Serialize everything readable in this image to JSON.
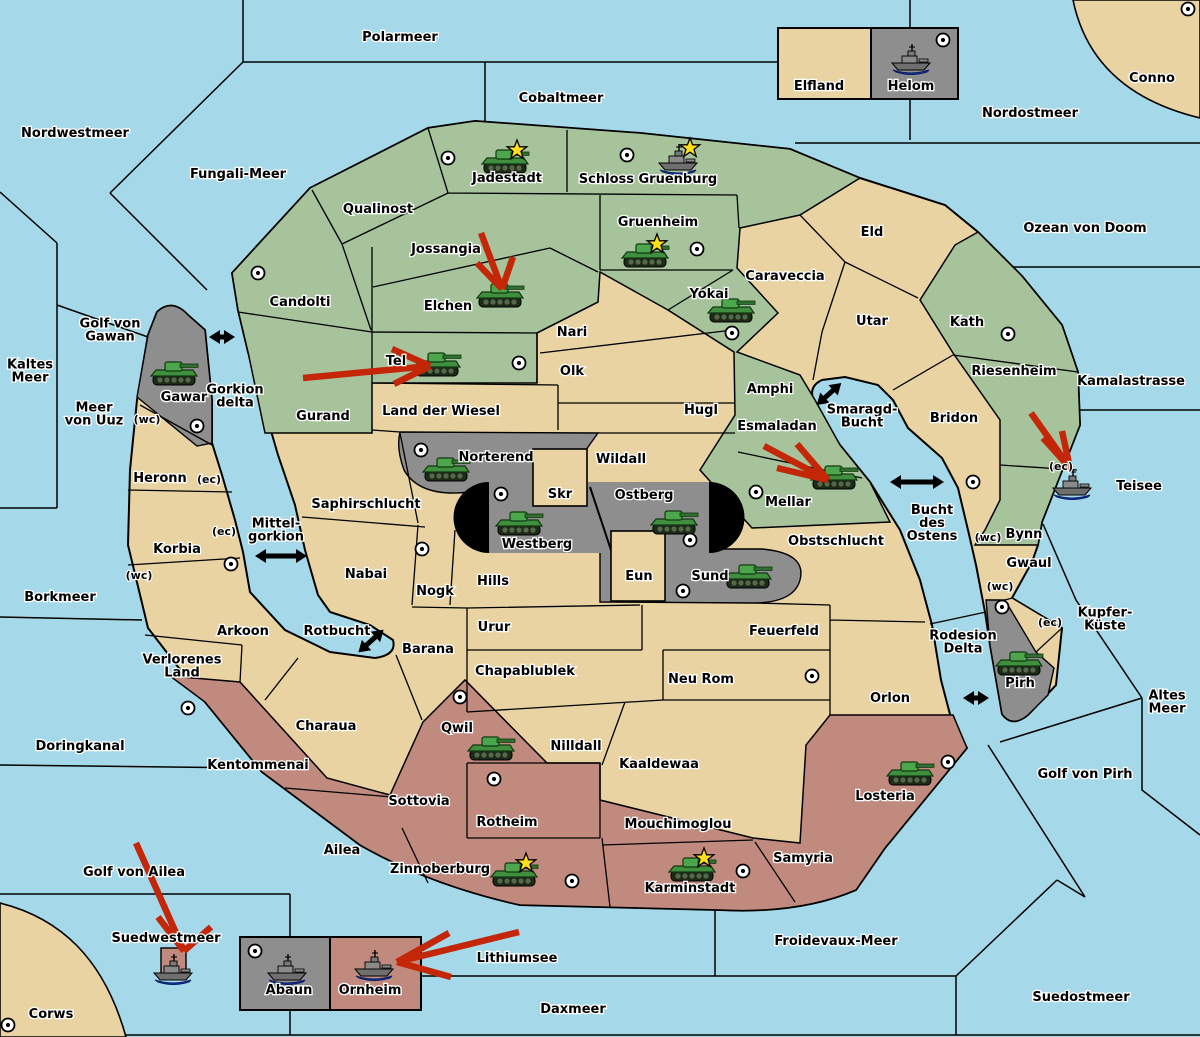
{
  "colors": {
    "sea": "#A5D8E8",
    "land": "#E9D3A3",
    "green": "#A6C39B",
    "maroon": "#C18A7E",
    "gray": "#8E8E8E",
    "ring": "#000000",
    "arrow_red": "#C42708",
    "tank_green": "#3F8F3F",
    "ship_gray": "#7A7A7A",
    "star_yellow": "#FFE01A"
  },
  "sea_labels": [
    {
      "text": "Polarmeer",
      "x": 400,
      "y": 37
    },
    {
      "text": "Cobaltmeer",
      "x": 561,
      "y": 98
    },
    {
      "text": "Nordostmeer",
      "x": 1030,
      "y": 113
    },
    {
      "text": "Nordwestmeer",
      "x": 75,
      "y": 133
    },
    {
      "text": "Fungali-Meer",
      "x": 238,
      "y": 174
    },
    {
      "text": "Ozean von Doom",
      "x": 1085,
      "y": 228
    },
    {
      "lines": [
        "Kaltes",
        "Meer"
      ],
      "x": 30,
      "y": 371
    },
    {
      "lines": [
        "Golf von",
        "Gawan"
      ],
      "x": 110,
      "y": 330
    },
    {
      "lines": [
        "Meer",
        "von Uuz"
      ],
      "x": 94,
      "y": 414
    },
    {
      "lines": [
        "Gorkion",
        "delta"
      ],
      "x": 235,
      "y": 396
    },
    {
      "text": "Borkmeer",
      "x": 60,
      "y": 597
    },
    {
      "lines": [
        "Mittel-",
        "gorkion"
      ],
      "x": 276,
      "y": 530
    },
    {
      "text": "Rotbucht",
      "x": 337,
      "y": 631
    },
    {
      "lines": [
        "Smaragd-",
        "Bucht"
      ],
      "x": 862,
      "y": 416
    },
    {
      "lines": [
        "Bucht",
        "des",
        "Ostens"
      ],
      "x": 932,
      "y": 523
    },
    {
      "text": "Kamalastrasse",
      "x": 1131,
      "y": 381
    },
    {
      "text": "Teisee",
      "x": 1139,
      "y": 486
    },
    {
      "lines": [
        "Kupfer-",
        "Küste"
      ],
      "x": 1105,
      "y": 619
    },
    {
      "lines": [
        "Altes",
        "Meer"
      ],
      "x": 1167,
      "y": 702
    },
    {
      "text": "Golf von Pirh",
      "x": 1085,
      "y": 774
    },
    {
      "lines": [
        "Rodesion",
        "Delta"
      ],
      "x": 963,
      "y": 642
    },
    {
      "text": "Doringkanal",
      "x": 80,
      "y": 746
    },
    {
      "text": "Golf von Ailea",
      "x": 134,
      "y": 872
    },
    {
      "text": "Suedwestmeer",
      "x": 166,
      "y": 938
    },
    {
      "text": "Lithiumsee",
      "x": 517,
      "y": 958
    },
    {
      "text": "Daxmeer",
      "x": 573,
      "y": 1009
    },
    {
      "text": "Froidevaux-Meer",
      "x": 836,
      "y": 941
    },
    {
      "text": "Suedostmeer",
      "x": 1081,
      "y": 997
    }
  ],
  "province_labels": [
    {
      "text": "Conno",
      "x": 1152,
      "y": 78
    },
    {
      "text": "Elfland",
      "x": 819,
      "y": 86
    },
    {
      "text": "Helom",
      "x": 911,
      "y": 86
    },
    {
      "text": "Qualinost",
      "x": 378,
      "y": 209
    },
    {
      "text": "Candolti",
      "x": 300,
      "y": 302
    },
    {
      "text": "Jossangia",
      "x": 446,
      "y": 249
    },
    {
      "text": "Jadestadt",
      "x": 507,
      "y": 178
    },
    {
      "text": "Schloss Gruenburg",
      "x": 648,
      "y": 179
    },
    {
      "text": "Gruenheim",
      "x": 658,
      "y": 222
    },
    {
      "text": "Elchen",
      "x": 448,
      "y": 306
    },
    {
      "text": "Tel",
      "x": 396,
      "y": 361
    },
    {
      "text": "Yokai",
      "x": 709,
      "y": 294
    },
    {
      "text": "Caraveccia",
      "x": 785,
      "y": 276
    },
    {
      "text": "Eld",
      "x": 872,
      "y": 232
    },
    {
      "text": "Utar",
      "x": 872,
      "y": 321
    },
    {
      "text": "Kath",
      "x": 967,
      "y": 322
    },
    {
      "text": "Riesenheim",
      "x": 1014,
      "y": 371
    },
    {
      "text": "Bridon",
      "x": 954,
      "y": 418
    },
    {
      "text": "Gurand",
      "x": 323,
      "y": 416
    },
    {
      "text": "Land der Wiesel",
      "x": 441,
      "y": 411
    },
    {
      "text": "Nari",
      "x": 572,
      "y": 332
    },
    {
      "text": "Olk",
      "x": 572,
      "y": 371
    },
    {
      "text": "Hugl",
      "x": 701,
      "y": 410
    },
    {
      "text": "Amphi",
      "x": 770,
      "y": 389
    },
    {
      "text": "Esmaladan",
      "x": 777,
      "y": 426
    },
    {
      "text": "Mellar",
      "x": 788,
      "y": 502
    },
    {
      "text": "Wildall",
      "x": 621,
      "y": 459
    },
    {
      "text": "Norterend",
      "x": 496,
      "y": 457
    },
    {
      "text": "Skr",
      "x": 560,
      "y": 494
    },
    {
      "text": "Ostberg",
      "x": 644,
      "y": 495
    },
    {
      "text": "Westberg",
      "x": 537,
      "y": 544
    },
    {
      "text": "Eun",
      "x": 639,
      "y": 576
    },
    {
      "text": "Sund",
      "x": 710,
      "y": 576
    },
    {
      "text": "Gawar",
      "x": 184,
      "y": 397
    },
    {
      "text": "Heronn",
      "x": 160,
      "y": 478
    },
    {
      "text": "Korbia",
      "x": 177,
      "y": 549
    },
    {
      "text": "Saphirschlucht",
      "x": 366,
      "y": 504
    },
    {
      "text": "Nabai",
      "x": 366,
      "y": 574
    },
    {
      "text": "Nogk",
      "x": 435,
      "y": 591
    },
    {
      "text": "Hills",
      "x": 493,
      "y": 581
    },
    {
      "text": "Urur",
      "x": 494,
      "y": 627
    },
    {
      "text": "Barana",
      "x": 428,
      "y": 649
    },
    {
      "text": "Chapablublek",
      "x": 525,
      "y": 671
    },
    {
      "text": "Nilldall",
      "x": 576,
      "y": 746
    },
    {
      "text": "Kaaldewaa",
      "x": 659,
      "y": 764
    },
    {
      "text": "Feuerfeld",
      "x": 784,
      "y": 631
    },
    {
      "text": "Neu Rom",
      "x": 701,
      "y": 679
    },
    {
      "text": "Obstschlucht",
      "x": 836,
      "y": 541
    },
    {
      "text": "Orlon",
      "x": 890,
      "y": 698
    },
    {
      "text": "Arkoon",
      "x": 243,
      "y": 631
    },
    {
      "lines": [
        "Verlorenes",
        "Land"
      ],
      "x": 182,
      "y": 666
    },
    {
      "text": "Charaua",
      "x": 326,
      "y": 726
    },
    {
      "text": "Kentommenai",
      "x": 258,
      "y": 765
    },
    {
      "text": "Ailea",
      "x": 342,
      "y": 850
    },
    {
      "text": "Sottovia",
      "x": 419,
      "y": 801
    },
    {
      "text": "Rotheim",
      "x": 507,
      "y": 822
    },
    {
      "text": "Qwil",
      "x": 457,
      "y": 728
    },
    {
      "text": "Zinnoberburg",
      "x": 440,
      "y": 869
    },
    {
      "text": "Mouchimoglou",
      "x": 678,
      "y": 824
    },
    {
      "text": "Karminstadt",
      "x": 690,
      "y": 888
    },
    {
      "text": "Samyria",
      "x": 803,
      "y": 858
    },
    {
      "text": "Losteria",
      "x": 885,
      "y": 796
    },
    {
      "text": "Bynn",
      "x": 1024,
      "y": 534
    },
    {
      "text": "Gwaul",
      "x": 1029,
      "y": 563
    },
    {
      "text": "Pirh",
      "x": 1020,
      "y": 683
    },
    {
      "text": "Abaun",
      "x": 289,
      "y": 990
    },
    {
      "text": "Ornheim",
      "x": 370,
      "y": 990
    },
    {
      "text": "Corws",
      "x": 51,
      "y": 1014
    }
  ],
  "coast_markers": [
    {
      "text": "(wc)",
      "x": 147,
      "y": 419
    },
    {
      "text": "(ec)",
      "x": 209,
      "y": 479
    },
    {
      "text": "(ec)",
      "x": 224,
      "y": 531
    },
    {
      "text": "(wc)",
      "x": 139,
      "y": 575
    },
    {
      "text": "(wc)",
      "x": 988,
      "y": 537
    },
    {
      "text": "(wc)",
      "x": 1000,
      "y": 586
    },
    {
      "text": "(ec)",
      "x": 1050,
      "y": 622
    },
    {
      "text": "(ec)",
      "x": 1061,
      "y": 466
    }
  ],
  "supply_centers": [
    [
      258,
      273
    ],
    [
      448,
      158
    ],
    [
      627,
      155
    ],
    [
      697,
      249
    ],
    [
      732,
      333
    ],
    [
      519,
      363
    ],
    [
      197,
      426
    ],
    [
      231,
      564
    ],
    [
      421,
      450
    ],
    [
      501,
      494
    ],
    [
      690,
      540
    ],
    [
      683,
      591
    ],
    [
      756,
      492
    ],
    [
      1008,
      334
    ],
    [
      973,
      482
    ],
    [
      943,
      40
    ],
    [
      1188,
      9
    ],
    [
      422,
      549
    ],
    [
      188,
      708
    ],
    [
      460,
      697
    ],
    [
      494,
      779
    ],
    [
      572,
      881
    ],
    [
      743,
      871
    ],
    [
      948,
      762
    ],
    [
      1002,
      607
    ],
    [
      812,
      676
    ],
    [
      255,
      951
    ],
    [
      8,
      1025
    ]
  ],
  "units": [
    {
      "type": "army",
      "province": "Jadestadt",
      "x": 505,
      "y": 162,
      "star": true
    },
    {
      "type": "fleet",
      "province": "Schloss Gruenburg",
      "x": 678,
      "y": 160,
      "star": true
    },
    {
      "type": "army",
      "province": "Gruenheim",
      "x": 645,
      "y": 256,
      "star": true
    },
    {
      "type": "army",
      "province": "Yokai",
      "x": 731,
      "y": 311,
      "star": false
    },
    {
      "type": "army",
      "province": "Elchen",
      "x": 500,
      "y": 296,
      "star": false
    },
    {
      "type": "army",
      "province": "Tel",
      "x": 437,
      "y": 365,
      "star": false
    },
    {
      "type": "army",
      "province": "Gawar",
      "x": 174,
      "y": 374,
      "star": false
    },
    {
      "type": "army",
      "province": "Norterend",
      "x": 446,
      "y": 470,
      "star": false
    },
    {
      "type": "army",
      "province": "Westberg",
      "x": 519,
      "y": 524,
      "star": false
    },
    {
      "type": "army",
      "province": "Ostberg",
      "x": 674,
      "y": 523,
      "star": false
    },
    {
      "type": "army",
      "province": "Sund",
      "x": 748,
      "y": 577,
      "star": false
    },
    {
      "type": "army",
      "province": "Mellar",
      "x": 834,
      "y": 478,
      "star": false
    },
    {
      "type": "army",
      "province": "Qwil",
      "x": 491,
      "y": 749,
      "star": false
    },
    {
      "type": "army",
      "province": "Zinnoberburg",
      "x": 514,
      "y": 875,
      "star": true
    },
    {
      "type": "army",
      "province": "Karminstadt",
      "x": 692,
      "y": 870,
      "star": true
    },
    {
      "type": "army",
      "province": "Losteria",
      "x": 910,
      "y": 774,
      "star": false
    },
    {
      "type": "army",
      "province": "Pirh",
      "x": 1019,
      "y": 664,
      "star": false
    },
    {
      "type": "fleet",
      "province": "Helom",
      "x": 911,
      "y": 60,
      "star": false
    },
    {
      "type": "fleet",
      "province": "Bynn (ec)",
      "x": 1072,
      "y": 485,
      "star": false
    },
    {
      "type": "fleet",
      "province": "Suedwestmeer",
      "x": 173,
      "y": 970,
      "star": false
    },
    {
      "type": "fleet",
      "province": "Abaun",
      "x": 287,
      "y": 970,
      "star": false
    },
    {
      "type": "fleet",
      "province": "Ornheim",
      "x": 374,
      "y": 966,
      "star": false
    }
  ],
  "move_arrows": [
    {
      "shaft": [
        [
          303,
          378
        ],
        [
          430,
          366
        ]
      ],
      "barbs": [
        [
          392,
          349
        ],
        [
          394,
          384
        ]
      ]
    },
    {
      "shaft": [
        [
          481,
          233
        ],
        [
          502,
          289
        ]
      ],
      "barbs": [
        [
          513,
          257
        ],
        [
          477,
          263
        ]
      ]
    },
    {
      "shaft": [
        [
          764,
          446
        ],
        [
          828,
          480
        ]
      ],
      "barbs": [
        [
          797,
          444
        ],
        [
          777,
          468
        ]
      ]
    },
    {
      "shaft": [
        [
          1031,
          413
        ],
        [
          1070,
          468
        ]
      ],
      "barbs": [
        [
          1043,
          438
        ],
        [
          1062,
          431
        ]
      ]
    },
    {
      "shaft": [
        [
          136,
          843
        ],
        [
          184,
          951
        ]
      ],
      "barbs": [
        [
          158,
          917
        ],
        [
          211,
          927
        ]
      ]
    },
    {
      "shaft": [
        [
          519,
          932
        ],
        [
          397,
          962
        ]
      ],
      "barbs": [
        [
          449,
          933
        ],
        [
          451,
          977
        ]
      ]
    }
  ],
  "strait_arrows": [
    {
      "x": 222,
      "y": 337,
      "angle": 0,
      "len": 26
    },
    {
      "x": 281,
      "y": 556,
      "angle": 0,
      "len": 52
    },
    {
      "x": 371,
      "y": 641,
      "angle": -42,
      "len": 34
    },
    {
      "x": 829,
      "y": 394,
      "angle": -42,
      "len": 33
    },
    {
      "x": 917,
      "y": 482,
      "angle": 0,
      "len": 54
    },
    {
      "x": 976,
      "y": 698,
      "angle": 0,
      "len": 26
    }
  ]
}
